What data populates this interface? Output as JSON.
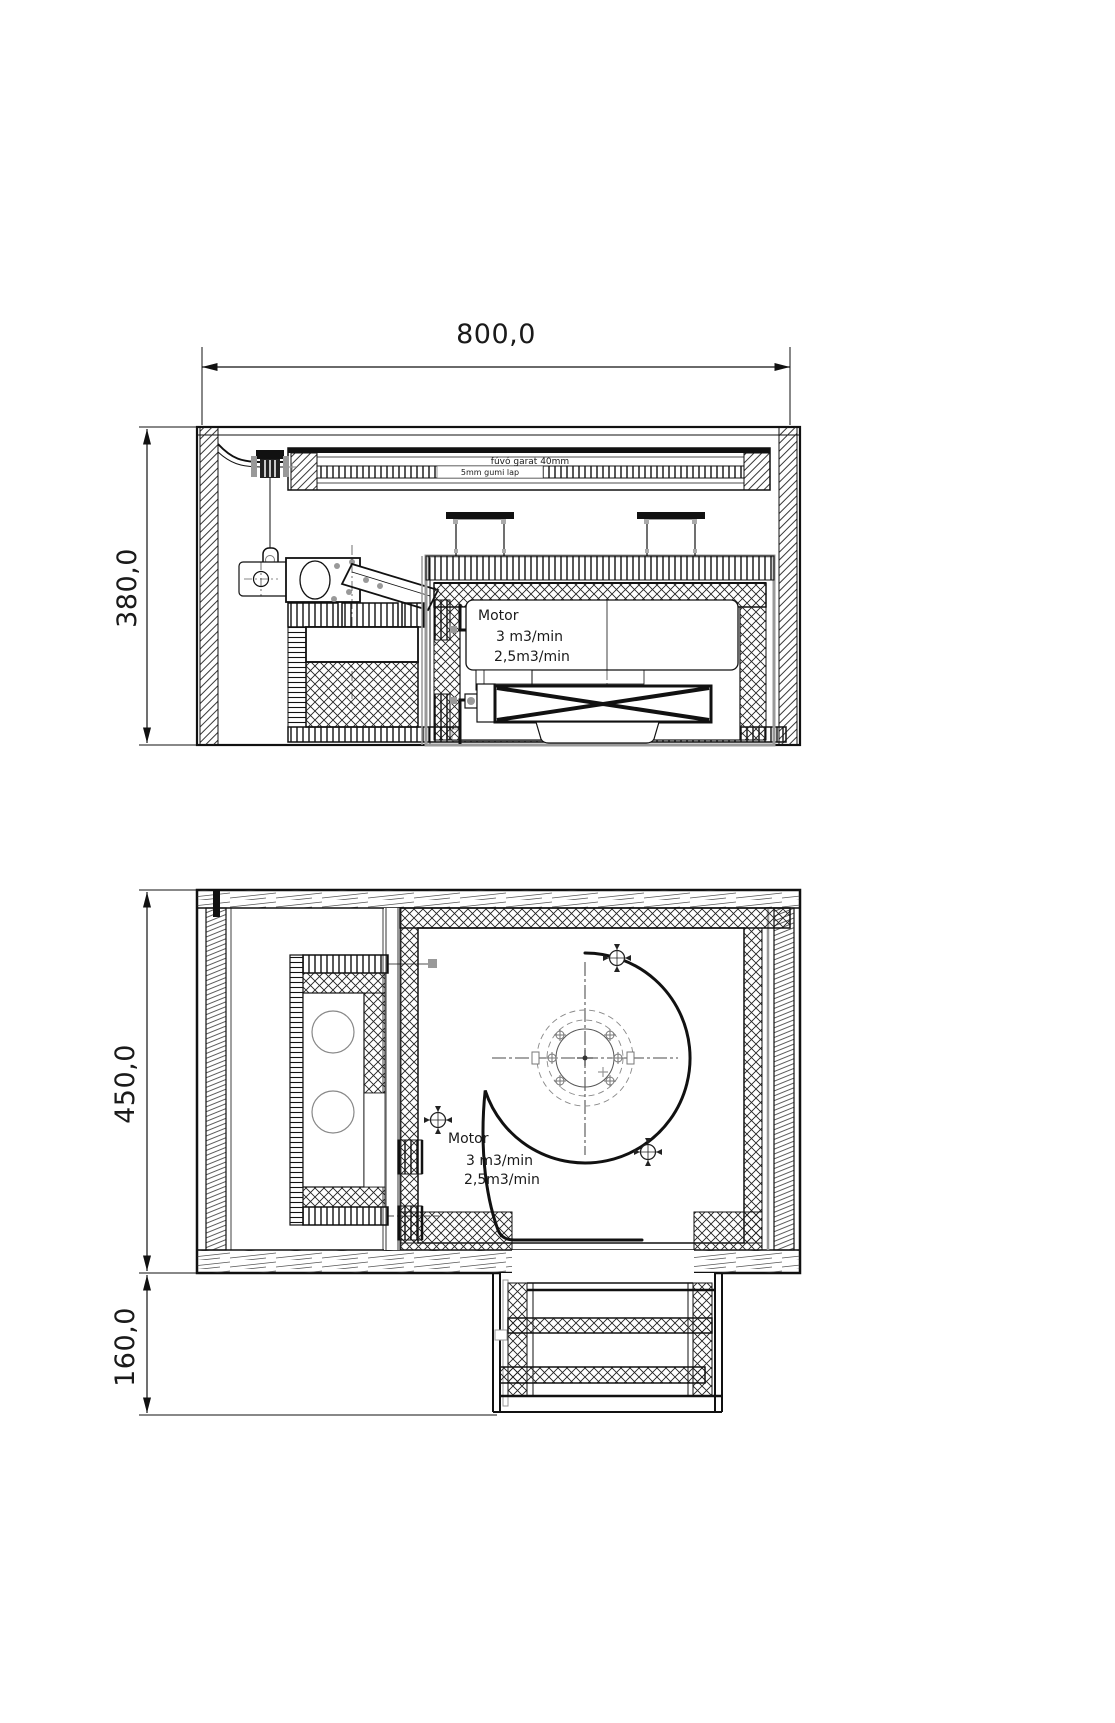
{
  "drawing": {
    "type": "technical-cad-drawing",
    "views": [
      "side-section-view",
      "plan-section-view"
    ],
    "colors": {
      "line": "#1a1a1a",
      "accent_gray": "#999999",
      "background": "#ffffff"
    }
  },
  "dimensions": {
    "width_top": "800,0",
    "side_height": "380,0",
    "plan_height": "450,0",
    "duct_height": "160,0"
  },
  "side_view": {
    "duct_label_top": "fúvó garat 40mm",
    "duct_label_inner": "5mm gumi lap",
    "base_label": "5mm-es gumi lap",
    "motor": {
      "name": "Motor",
      "flow_max": "3 m3/min",
      "flow_min": "2,5m3/min"
    }
  },
  "plan_view": {
    "motor": {
      "name": "Motor",
      "flow_max": "3 m3/min",
      "flow_min": "2,5m3/min"
    }
  }
}
